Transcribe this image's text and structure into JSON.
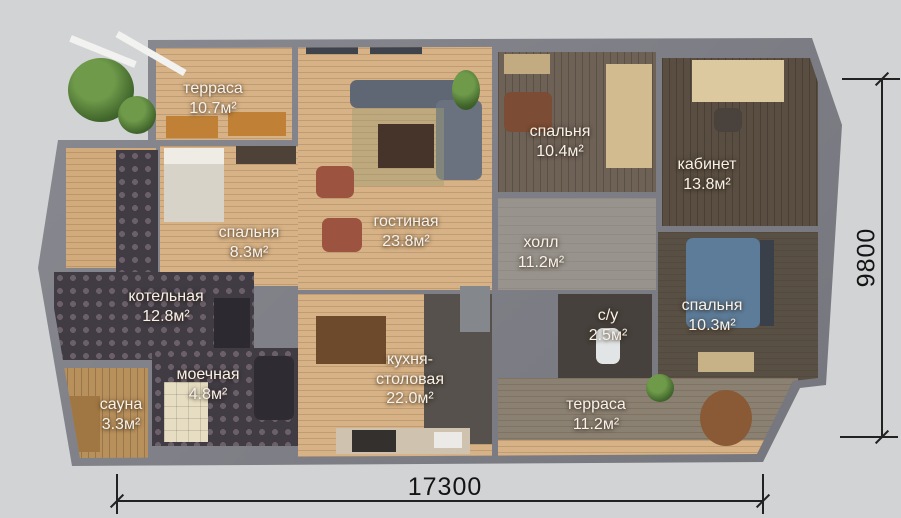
{
  "plan_title": "floor-plan",
  "rooms": [
    {
      "id": "terrace-top",
      "name": "терраса",
      "area": "10.7м²"
    },
    {
      "id": "bedroom-left",
      "name": "спальня",
      "area": "8.3м²"
    },
    {
      "id": "living-room",
      "name": "гостиная",
      "area": "23.8м²"
    },
    {
      "id": "bedroom-top",
      "name": "спальня",
      "area": "10.4м²"
    },
    {
      "id": "office",
      "name": "кабинет",
      "area": "13.8м²"
    },
    {
      "id": "hall",
      "name": "холл",
      "area": "11.2м²"
    },
    {
      "id": "boiler-room",
      "name": "котельная",
      "area": "12.8м²"
    },
    {
      "id": "wash-room",
      "name": "моечная",
      "area": "4.8м²"
    },
    {
      "id": "sauna",
      "name": "сауна",
      "area": "3.3м²"
    },
    {
      "id": "kitchen-dining",
      "name": "кухня-\nстоловая",
      "area": "22.0м²"
    },
    {
      "id": "bathroom",
      "name": "с/у",
      "area": "2.5м²"
    },
    {
      "id": "bedroom-right",
      "name": "спальня",
      "area": "10.3м²"
    },
    {
      "id": "terrace-bottom",
      "name": "терраса",
      "area": "11.2м²"
    }
  ],
  "dimensions": {
    "width": "17300",
    "height": "9800"
  },
  "colors": {
    "background": "#d2d3d4",
    "walls": "#7f8188",
    "wood_light": "#d7b286",
    "deck_gray": "#8b8173",
    "tile_dark": "#413c44",
    "label_text": "#f6f2ea",
    "dimension_text": "#141414",
    "bed_blue": "#5d7c99"
  }
}
